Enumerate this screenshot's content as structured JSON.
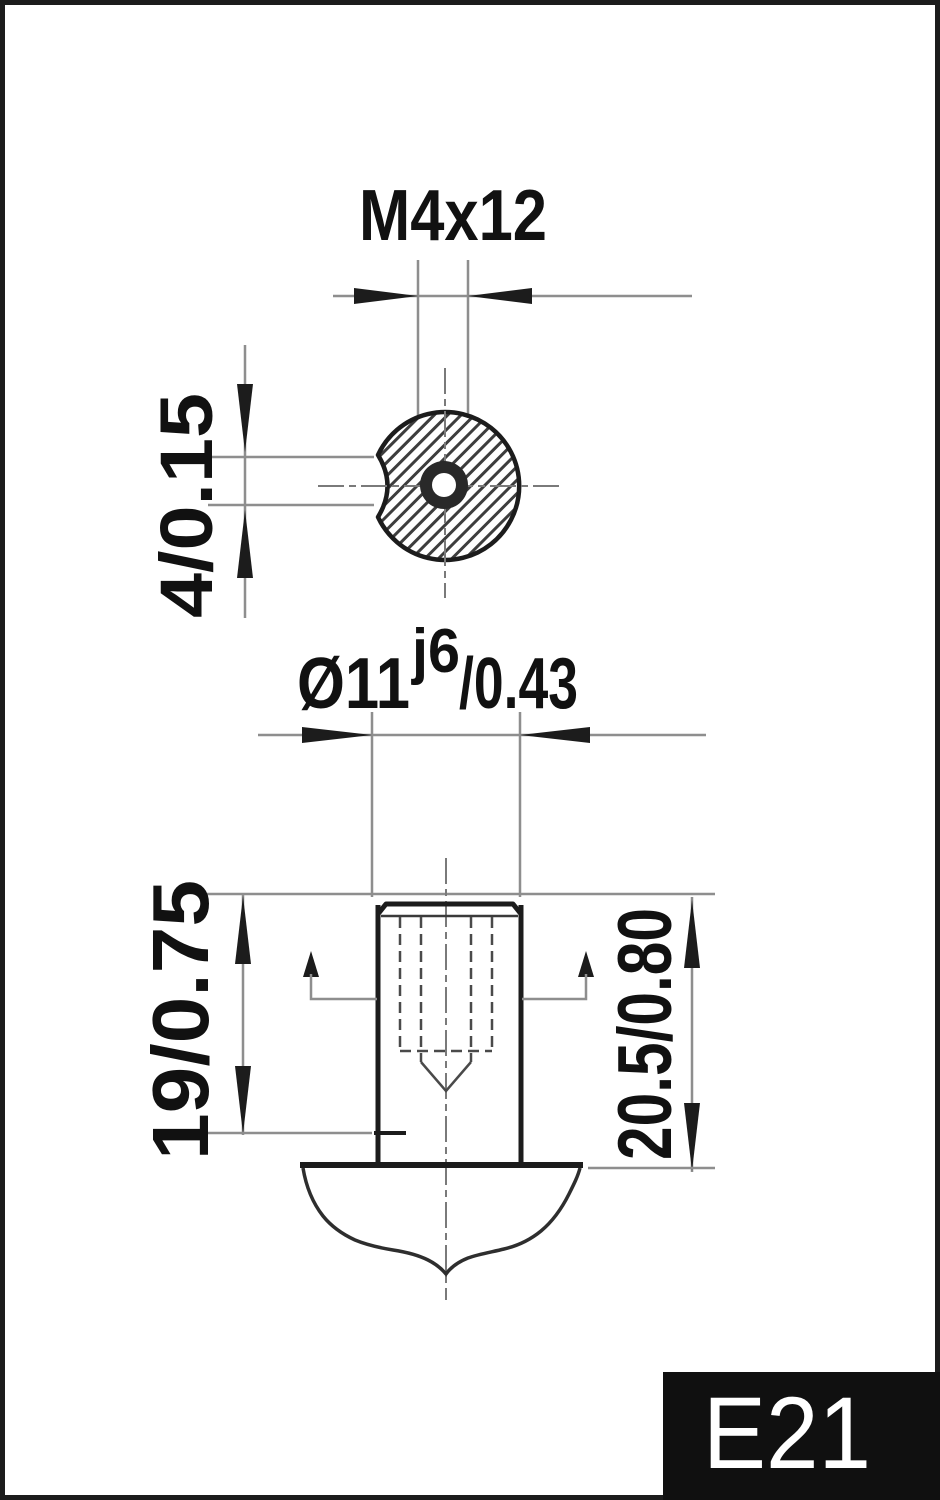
{
  "colors": {
    "line": "#1c1c1c",
    "dim": "#8e8e8e",
    "hidden": "#4a4a4a",
    "center": "#7a7a7a",
    "hatch": "#3d3d3d",
    "arrow": "#1c1c1c",
    "text": "#111111",
    "badge_bg": "#101010",
    "badge_text": "#ffffff",
    "bg": "#ffffff"
  },
  "top_view": {
    "thread_dim_label": "M4x12",
    "notch_dim_label": "4/0.15"
  },
  "front_view": {
    "diameter_label_base": "Ø11",
    "diameter_label_sup": "j6",
    "diameter_label_tol": "/0.43",
    "length_dim_label": "19/0.75",
    "overall_length_dim_label": "20.5/0.80"
  },
  "badge": {
    "part_code": "E21"
  }
}
